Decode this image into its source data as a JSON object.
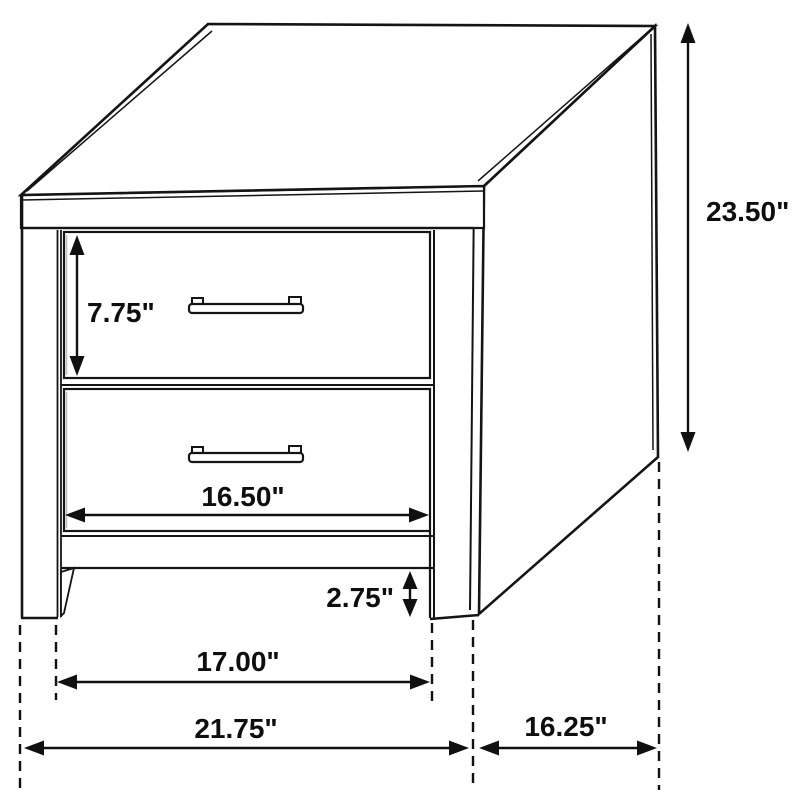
{
  "diagram": {
    "kind": "furniture-dimension-line-drawing",
    "subject": "two-drawer nightstand",
    "line_color": "#141414",
    "background_color": "#ffffff",
    "labels": {
      "drawer_height": "7.75\"",
      "drawer_width": "16.50\"",
      "base_height": "2.75\"",
      "inner_width": "17.00\"",
      "overall_width": "21.75\"",
      "depth": "16.25\"",
      "overall_height": "23.50\""
    }
  }
}
